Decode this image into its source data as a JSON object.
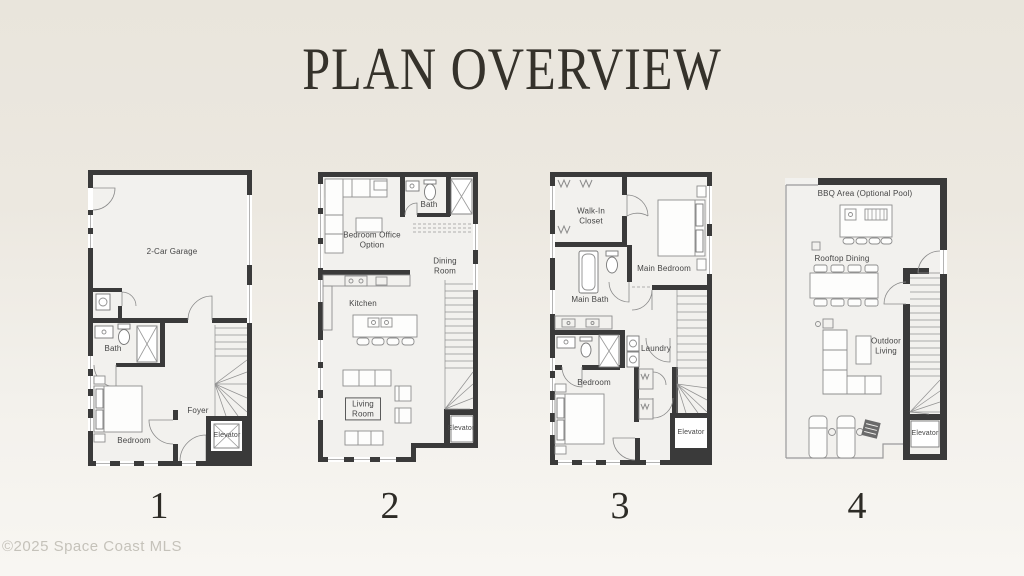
{
  "title": "PLAN OVERVIEW",
  "watermark": "©2025 Space Coast MLS",
  "colors": {
    "background_top": "#e9e5dc",
    "background_bottom": "#f8f6f2",
    "wall": "#3a3a3a",
    "floor": "#f2f1ee",
    "label_text": "#454545",
    "title_text": "#35322b",
    "watermark_text": "#c5c2ba"
  },
  "plans": [
    {
      "number": "1",
      "labels": {
        "garage": "2-Car Garage",
        "bath": "Bath",
        "bedroom": "Bedroom",
        "foyer": "Foyer",
        "elevator": "Elevator"
      }
    },
    {
      "number": "2",
      "labels": {
        "bedroom_office": "Bedroom Office Option",
        "bath": "Bath",
        "dining_room": "Dining Room",
        "kitchen": "Kitchen",
        "living_room": "Living Room",
        "elevator": "Elevator"
      }
    },
    {
      "number": "3",
      "labels": {
        "walk_in_closet": "Walk-In Closet",
        "main_bedroom": "Main Bedroom",
        "main_bath": "Main Bath",
        "laundry": "Laundry",
        "bedroom": "Bedroom",
        "elevator": "Elevator"
      }
    },
    {
      "number": "4",
      "labels": {
        "bbq_area": "BBQ Area (Optional Pool)",
        "rooftop_dining": "Rooftop Dining",
        "outdoor_living": "Outdoor Living",
        "elevator": "Elevator"
      }
    }
  ]
}
